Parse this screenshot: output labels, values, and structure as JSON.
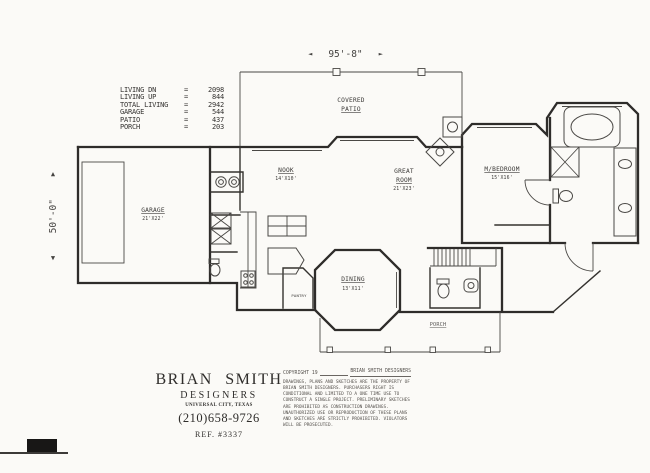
{
  "sheet": {
    "background": "#fbfaf7",
    "ink": "#2e2c2a"
  },
  "dimensions": {
    "width": {
      "label": "95'-8\"",
      "arrow_left": "◄",
      "arrow_right": "►"
    },
    "height": {
      "label": "50'-0\"",
      "arrow_up": "▲",
      "arrow_down": "▼"
    }
  },
  "area_table": {
    "equals": "=",
    "rows": [
      {
        "label": "LIVING DN",
        "value": "2098"
      },
      {
        "label": "LIVING UP",
        "value": "844"
      },
      {
        "label": "TOTAL LIVING",
        "value": "2942"
      },
      {
        "label": "GARAGE",
        "value": "544"
      },
      {
        "label": "PATIO",
        "value": "437"
      },
      {
        "label": "PORCH",
        "value": "203"
      }
    ]
  },
  "rooms": {
    "covered_patio_line1": "COVERED",
    "covered_patio_line2": "PATIO",
    "garage_name": "GARAGE",
    "garage_dim": "21'X22'",
    "nook_name": "NOOK",
    "nook_dim": "14'X10'",
    "great_room_line1": "GREAT",
    "great_room_line2": "ROOM",
    "great_room_dim": "21'X23'",
    "master_bedroom_name": "M/BEDROOM",
    "master_bedroom_dim": "15'X16'",
    "dining_name": "DINING",
    "dining_dim": "13'X11'",
    "pantry_name": "PANTRY",
    "porch_name": "PORCH"
  },
  "title_block": {
    "firm_line1": "BRIAN SMITH",
    "firm_line2": "DESIGNERS",
    "firm_line3": "UNIVERSAL CITY, TEXAS",
    "phone": "(210)658-9726",
    "reference": "REF. #3337"
  },
  "copyright": {
    "header_left": "COPYRIGHT 19",
    "header_right": "BRIAN SMITH DESIGNERS",
    "body": "DRAWINGS, PLANS AND SKETCHES ARE THE PROPERTY OF BRIAN SMITH DESIGNERS.  PURCHASERS RIGHT IS CONDITIONAL AND LIMITED TO A ONE TIME USE TO CONSTRUCT A SINGLE PROJECT.  PRELIMINARY SKETCHES ARE PROHIBITED AS CONSTRUCTION DRAWINGS.  UNAUTHORIZED USE OR REPRODUCTION OF THESE PLANS AND SKETCHES ARE STRICTLY PROHIBITED.  VIOLATORS WILL BE PROSECUTED."
  }
}
